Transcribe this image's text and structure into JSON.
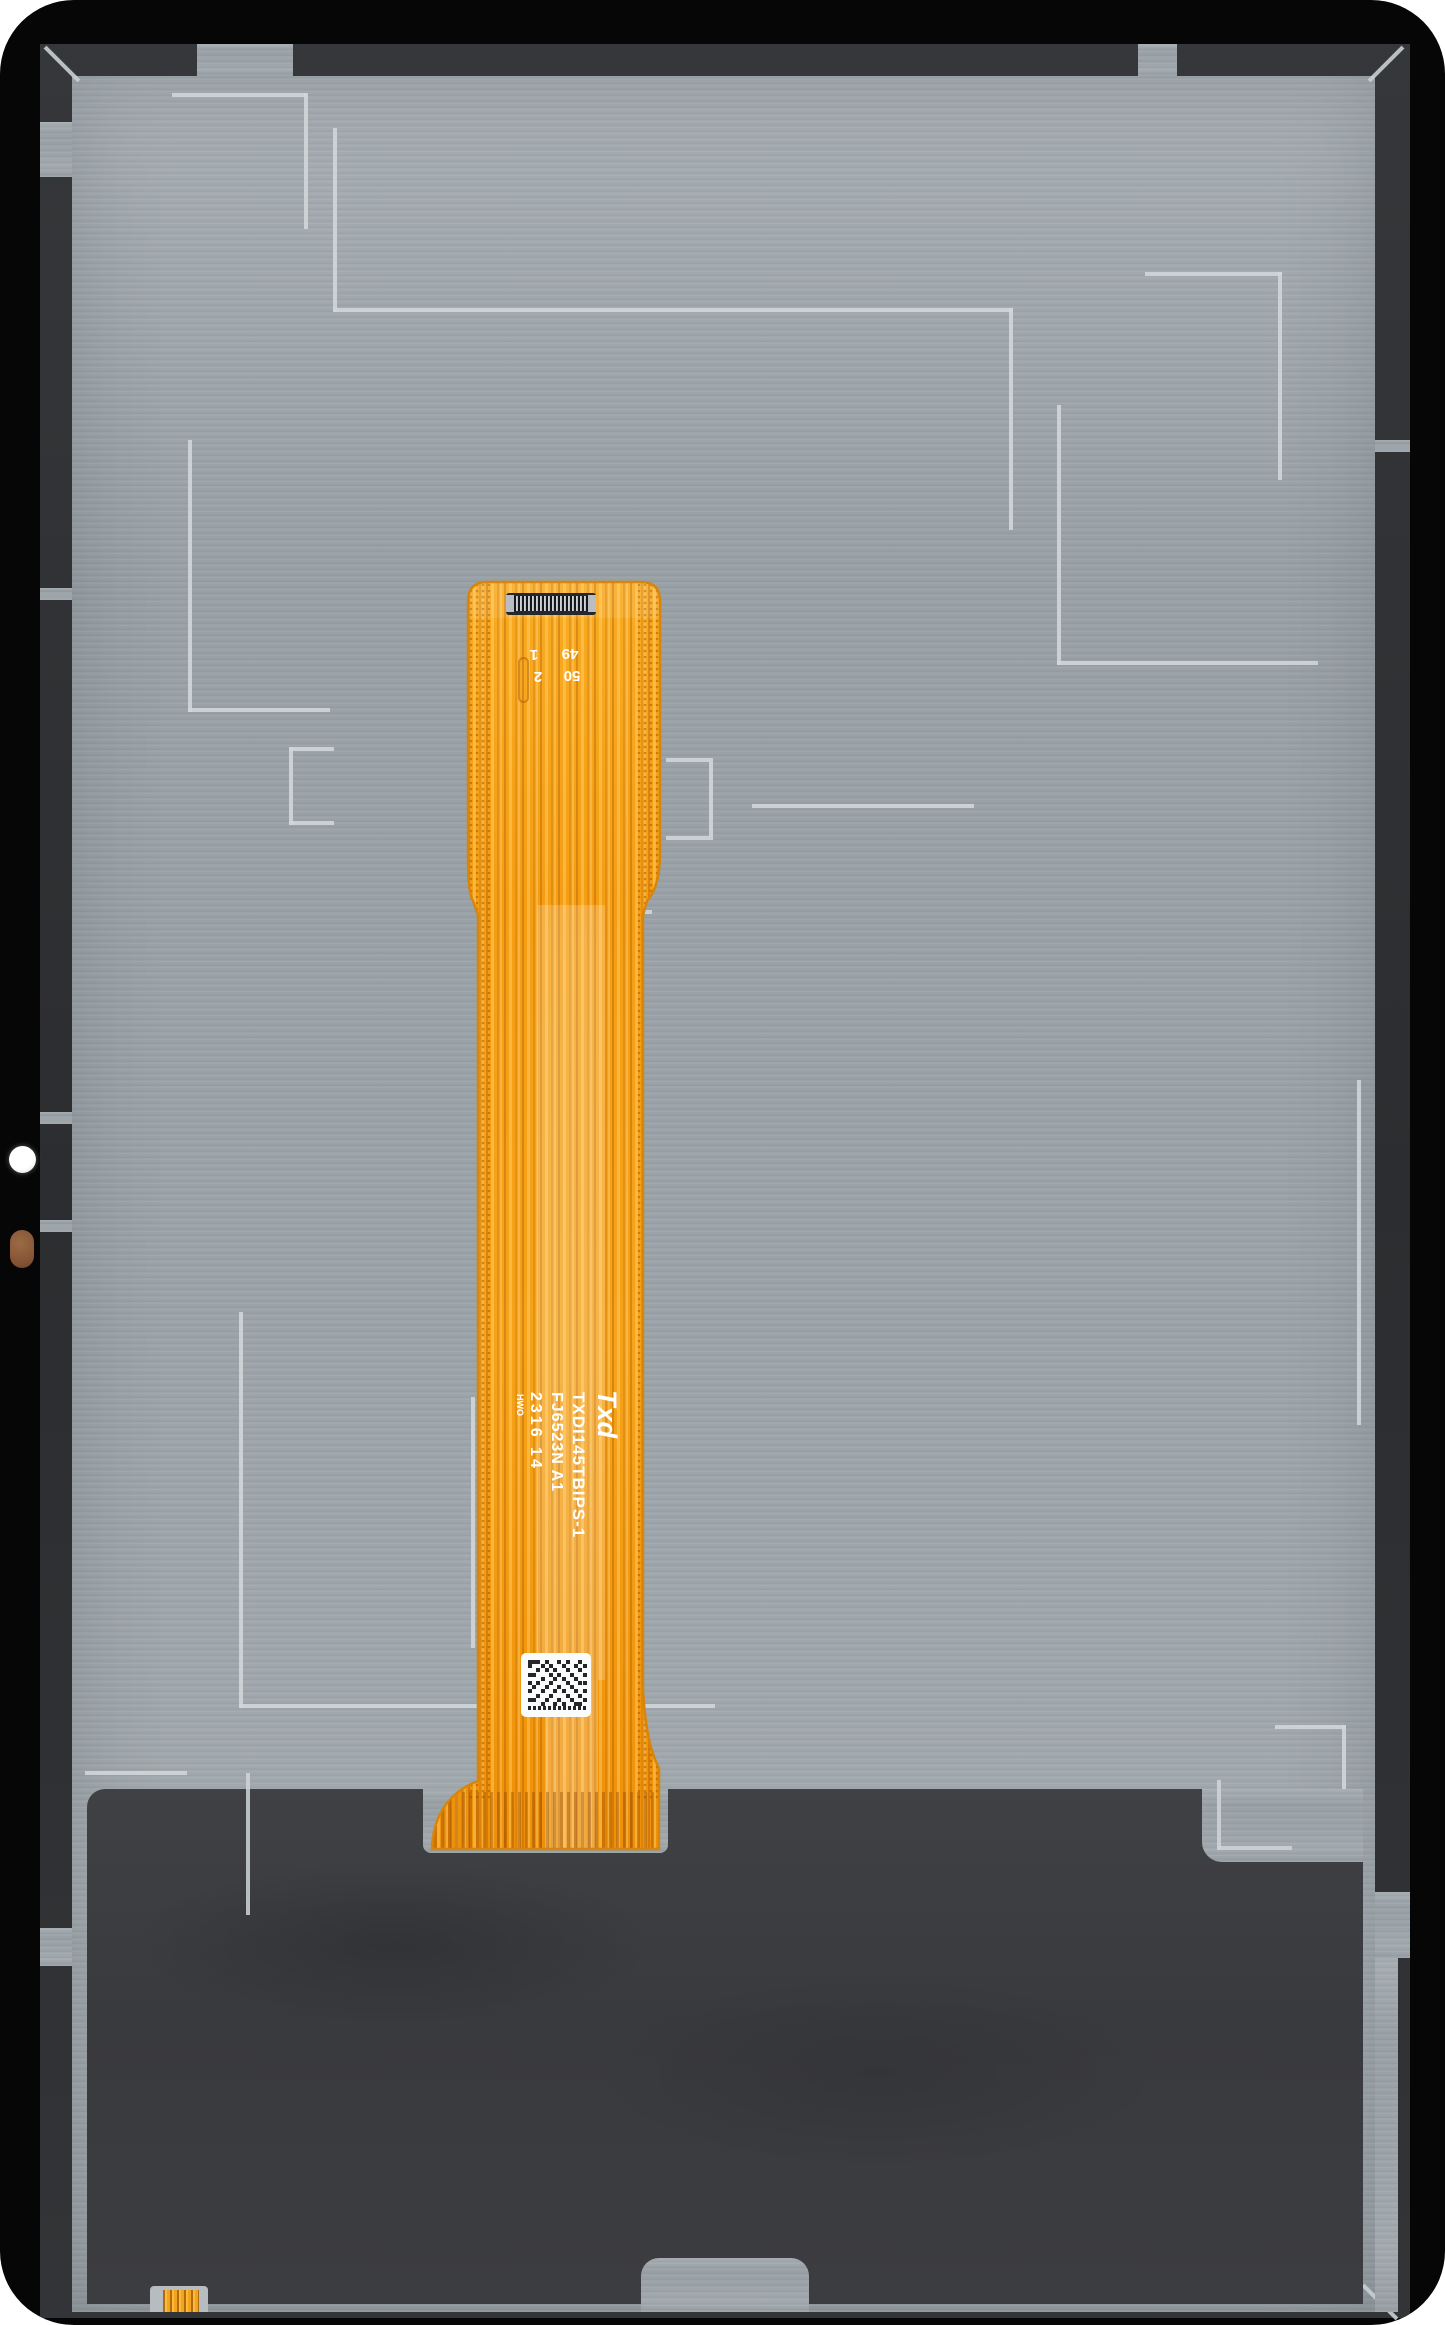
{
  "photo": {
    "subject": "tablet LCD display assembly, rear view with main flex ribbon cable",
    "background_color": "#ffffff"
  },
  "flex_label": {
    "brand_logo": "Txd",
    "model": "TXDI145TBIPS-1",
    "part_number": "FJ6523N A1",
    "date_code": "2316 14",
    "factory_mark": "HWO"
  },
  "connector_pins": {
    "pin_first": "1",
    "pin_second": "2",
    "pin_49": "49",
    "pin_50": "50"
  },
  "colors": {
    "flex_orange": "#f5a01a",
    "flex_edge": "#d8850b",
    "back_plate_gray": "#9da5aa",
    "bezel_charcoal": "#313335",
    "bottom_shield": "#3c3d41",
    "antenna_line": "#d2d7d9",
    "frame_black": "#060607",
    "camera_white": "#ffffff",
    "pad_copper": "#855334"
  }
}
